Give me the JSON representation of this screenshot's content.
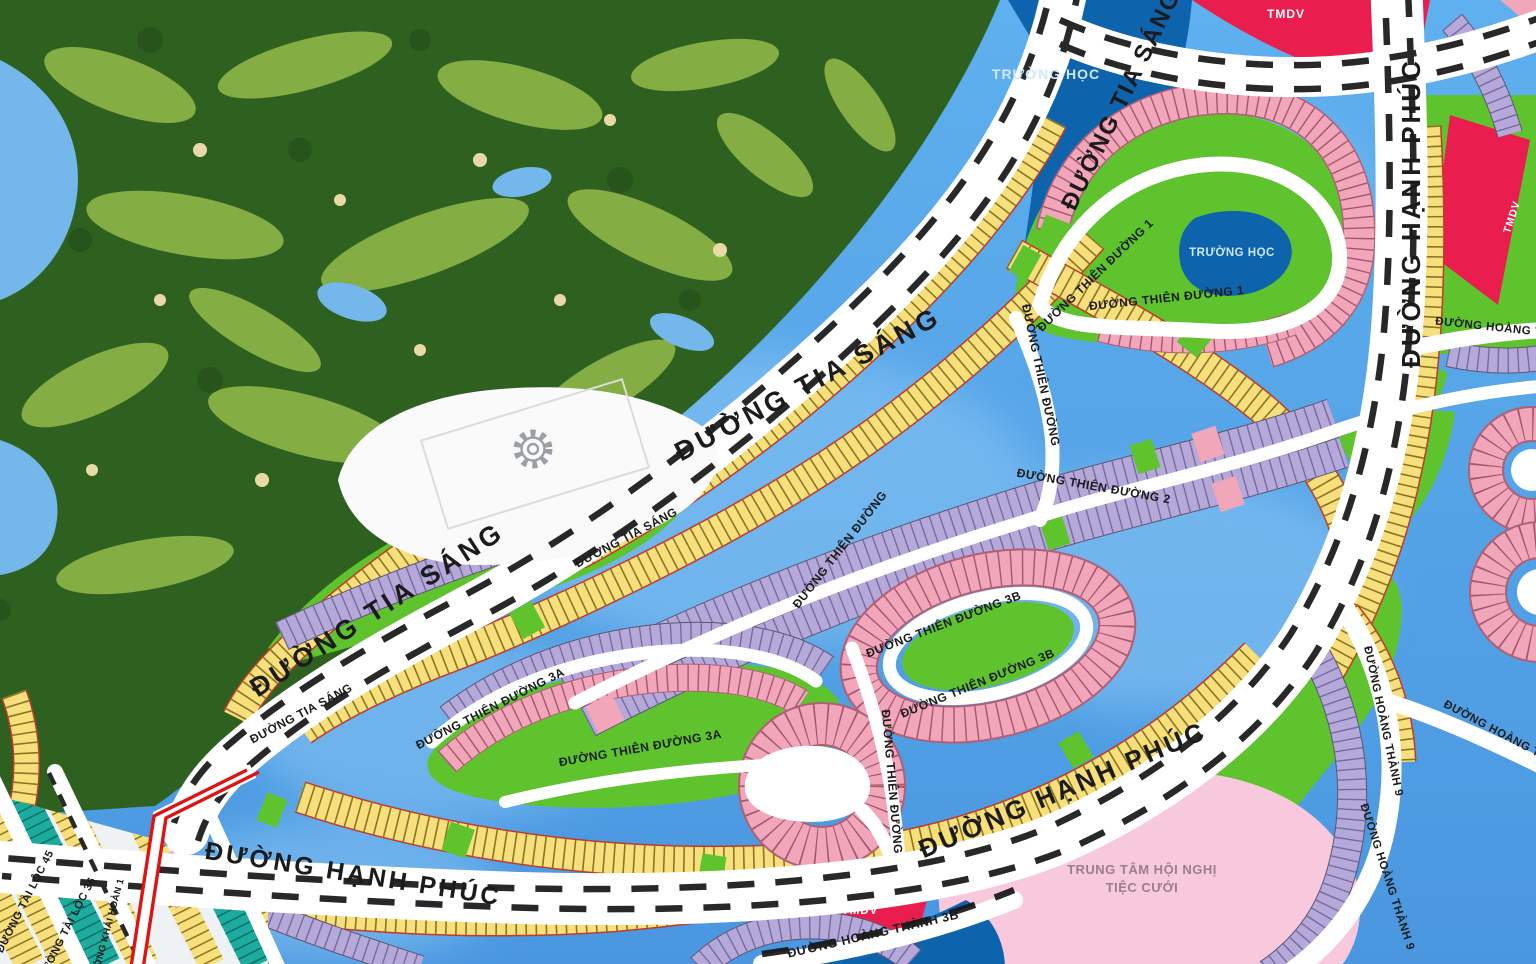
{
  "map": {
    "icons": [
      {
        "name": "gear-icon",
        "meaning": "utility/amenity marker on plaza"
      }
    ],
    "colors": {
      "water": "#4f9de6",
      "waterLight": "#8ac6f4",
      "golfBase": "#2e611f",
      "golfFairway": "#8fb648",
      "golfSand": "#ead9a8",
      "road": "#ffffff",
      "roadDash": "#151515",
      "lotYellow": "#f7e07b",
      "lotYellowTick": "#8a7426",
      "lotYellowEdge": "#c0392b",
      "lotPink": "#f2a6ba",
      "lotPinkTick": "#a3566d",
      "lotPurple": "#b5a9d9",
      "lotPurpleTick": "#77699f",
      "lotTeal": "#1cab9e",
      "lotTealTick": "#0e6f66",
      "parkGreen": "#5fc32e",
      "schoolBlue": "#0e63ad",
      "commercialRed": "#e91e4f",
      "eventPink": "#f8c9dc",
      "routeRed": "#e01313",
      "labelDark": "#1b1b1b",
      "labelLight": "#cfe8ff",
      "labelWhite": "#ffffff",
      "labelMuted": "#9a7f8d"
    },
    "labels": [
      {
        "id": "road-tia-sang-top",
        "text": "ĐƯỜNG TIA SÁNG",
        "x": 1128,
        "y": 103,
        "rot": -64,
        "size": 24,
        "color": "labelDark",
        "ls": 2
      },
      {
        "id": "road-tia-sang-mid",
        "text": "ĐƯỜNG TIA SÁNG",
        "x": 812,
        "y": 392,
        "rot": -28,
        "size": 27,
        "color": "labelDark",
        "ls": 4
      },
      {
        "id": "road-tia-sang-low",
        "text": "ĐƯỜNG TIA SÁNG",
        "x": 382,
        "y": 617,
        "rot": -33,
        "size": 27,
        "color": "labelDark",
        "ls": 4
      },
      {
        "id": "road-tia-sang-island-1",
        "text": "ĐƯỜNG TIA SÁNG",
        "x": 628,
        "y": 541,
        "rot": -28,
        "size": 12,
        "color": "labelDark",
        "ls": 0.5
      },
      {
        "id": "road-tia-sang-island-2",
        "text": "ĐƯỜNG TIA SÁNG",
        "x": 303,
        "y": 717,
        "rot": -28,
        "size": 12,
        "color": "labelDark",
        "ls": 0.5
      },
      {
        "id": "road-hanh-phuc-right",
        "text": "ĐƯỜNG HẠNH PHÚC",
        "x": 1420,
        "y": 213,
        "rot": -90,
        "size": 26,
        "color": "labelDark",
        "ls": 3
      },
      {
        "id": "road-hanh-phuc-mid",
        "text": "ĐƯỜNG HẠNH PHÚC",
        "x": 1066,
        "y": 798,
        "rot": -23,
        "size": 26,
        "color": "labelDark",
        "ls": 3
      },
      {
        "id": "road-hanh-phuc-left",
        "text": "ĐƯỜNG HẠNH PHÚC",
        "x": 352,
        "y": 882,
        "rot": 9,
        "size": 25,
        "color": "labelDark",
        "ls": 3
      },
      {
        "id": "road-thien-duong-1-a",
        "text": "ĐƯỜNG THIÊN ĐƯỜNG 1",
        "x": 1098,
        "y": 278,
        "rot": -44,
        "size": 12,
        "color": "labelDark",
        "ls": 0.5
      },
      {
        "id": "road-thien-duong-1-b",
        "text": "ĐƯỜNG THIÊN ĐƯỜNG 1",
        "x": 1167,
        "y": 302,
        "rot": -6,
        "size": 12,
        "color": "labelDark",
        "ls": 0.5
      },
      {
        "id": "road-thien-duong-2",
        "text": "ĐƯỜNG THIÊN ĐƯỜNG 2",
        "x": 1093,
        "y": 490,
        "rot": 10,
        "size": 12,
        "color": "labelDark",
        "ls": 0.5
      },
      {
        "id": "road-thien-duong-3a-a",
        "text": "ĐƯỜNG THIÊN ĐƯỜNG 3A",
        "x": 492,
        "y": 712,
        "rot": -27,
        "size": 12,
        "color": "labelDark",
        "ls": 0.5
      },
      {
        "id": "road-thien-duong-3a-b",
        "text": "ĐƯỜNG THIÊN ĐƯỜNG 3A",
        "x": 641,
        "y": 752,
        "rot": -10,
        "size": 12,
        "color": "labelDark",
        "ls": 0.5
      },
      {
        "id": "road-thien-duong-3b-a",
        "text": "ĐƯỜNG THIÊN ĐƯỜNG 3B",
        "x": 945,
        "y": 628,
        "rot": -21,
        "size": 12,
        "color": "labelDark",
        "ls": 0.5
      },
      {
        "id": "road-thien-duong-3b-b",
        "text": "ĐƯỜNG THIÊN ĐƯỜNG 3B",
        "x": 979,
        "y": 687,
        "rot": -22,
        "size": 12,
        "color": "labelDark",
        "ls": 0.5
      },
      {
        "id": "road-thien-duong-vert-1",
        "text": "ĐƯỜNG THIÊN ĐƯỜNG",
        "x": 1037,
        "y": 376,
        "rot": 78,
        "size": 12,
        "color": "labelDark",
        "ls": 0.5
      },
      {
        "id": "road-thien-duong-diag",
        "text": "ĐƯỜNG THIÊN ĐƯỜNG",
        "x": 843,
        "y": 552,
        "rot": -52,
        "size": 12,
        "color": "labelDark",
        "ls": 0.5
      },
      {
        "id": "road-thien-duong-vert-2",
        "text": "ĐƯỜNG THIÊN ĐƯỜNG",
        "x": 888,
        "y": 782,
        "rot": 85,
        "size": 12,
        "color": "labelDark",
        "ls": 0.5
      },
      {
        "id": "area-school-top",
        "text": "TRƯỜNG HỌC",
        "x": 1046,
        "y": 79,
        "rot": 0,
        "size": 14,
        "color": "labelLight",
        "ls": 1
      },
      {
        "id": "area-school-inner",
        "text": "TRƯỜNG HỌC",
        "x": 1232,
        "y": 256,
        "rot": 0,
        "size": 11.5,
        "color": "labelLight",
        "ls": 0.5
      },
      {
        "id": "area-tmdv-top",
        "text": "TMDV",
        "x": 1286,
        "y": 18,
        "rot": 0,
        "size": 12,
        "color": "labelWhite",
        "ls": 1
      },
      {
        "id": "area-tmdv-right",
        "text": "TMDV",
        "x": 1515,
        "y": 218,
        "rot": -72,
        "size": 10.5,
        "color": "labelWhite",
        "ls": 1
      },
      {
        "id": "area-tmdv-bottom",
        "text": "TMDV",
        "x": 860,
        "y": 914,
        "rot": 0,
        "size": 11.5,
        "color": "labelWhite",
        "ls": 1
      },
      {
        "id": "area-event-center-line1",
        "text": "TRUNG TÂM HỘI NGHỊ",
        "x": 1142,
        "y": 874,
        "rot": 0,
        "size": 13,
        "color": "labelMuted",
        "ls": 0.5
      },
      {
        "id": "area-event-center-line2",
        "text": "TIỆC CƯỚI",
        "x": 1142,
        "y": 892,
        "rot": 0,
        "size": 13,
        "color": "labelMuted",
        "ls": 0.5
      },
      {
        "id": "road-hoang-thanh-9-a",
        "text": "ĐƯỜNG HOÀNG THÀNH 9",
        "x": 1380,
        "y": 722,
        "rot": 78,
        "size": 11.5,
        "color": "labelDark",
        "ls": 0.5
      },
      {
        "id": "road-hoang-thanh-9-b",
        "text": "ĐƯỜNG HOÀNG THÀNH 9",
        "x": 1384,
        "y": 878,
        "rot": 72,
        "size": 11.5,
        "color": "labelDark",
        "ls": 0.5
      },
      {
        "id": "road-hoang-thanh-top",
        "text": "ĐƯỜNG HOÀNG THÀNH",
        "x": 1506,
        "y": 332,
        "rot": 6,
        "size": 11.5,
        "color": "labelDark",
        "ls": 0.5
      },
      {
        "id": "road-hoang-thanh-diag",
        "text": "ĐƯỜNG HOÀNG THÀNH",
        "x": 1506,
        "y": 740,
        "rot": 28,
        "size": 11.5,
        "color": "labelDark",
        "ls": 0.5
      },
      {
        "id": "road-hoang-thanh-3b",
        "text": "ĐƯỜNG HOÀNG THÀNH 3B",
        "x": 874,
        "y": 938,
        "rot": -13,
        "size": 12.5,
        "color": "labelDark",
        "ls": 0.5
      },
      {
        "id": "road-tai-loc-45",
        "text": "ĐƯỜNG TÀI LỘC 45",
        "x": 28,
        "y": 903,
        "rot": -63,
        "size": 11,
        "color": "labelDark",
        "ls": 0.5
      },
      {
        "id": "road-tai-loc-36",
        "text": "ĐƯỜNG TÀI LỘC 36",
        "x": 70,
        "y": 930,
        "rot": -63,
        "size": 11,
        "color": "labelDark",
        "ls": 0.5
      },
      {
        "id": "road-khai-hoan-1",
        "text": "ĐƯỜNG KHẢI HOÀN 1",
        "x": 110,
        "y": 931,
        "rot": -75,
        "size": 9.5,
        "color": "labelDark",
        "ls": 0.3
      }
    ]
  }
}
